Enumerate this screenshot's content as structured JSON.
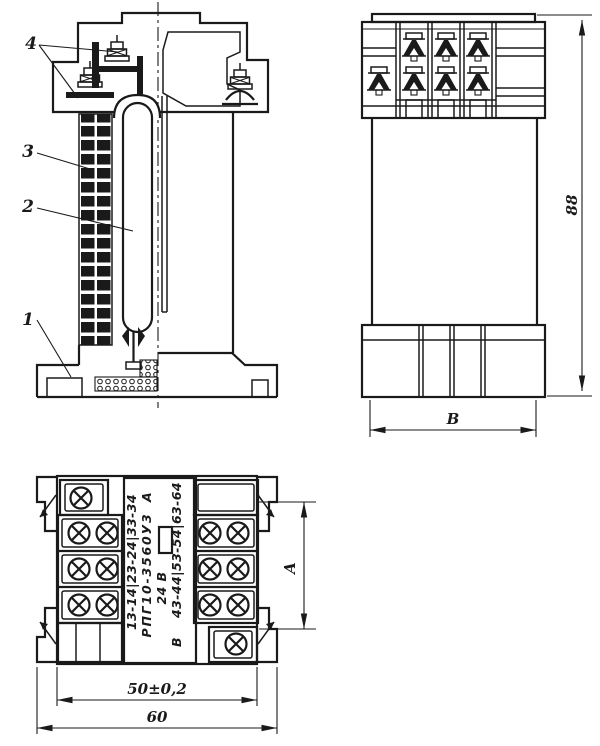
{
  "colors": {
    "ink": "#1a1a1a",
    "paper": "#ffffff"
  },
  "section_view": {
    "callouts": [
      {
        "label": "1"
      },
      {
        "label": "2"
      },
      {
        "label": "3"
      },
      {
        "label": "4"
      }
    ]
  },
  "side_view": {
    "dim_height": "88",
    "dim_width": "В"
  },
  "bottom_view": {
    "nameplate": {
      "contacts_left": "13-14|23-24|33-34",
      "terminal_a": "А",
      "model": "РПГ10-3560У3",
      "voltage": "24 В",
      "terminal_b": "В",
      "contacts_right": "43-44|53-54|63-64"
    },
    "dim_span": "А",
    "dim_mounting": "50±0,2",
    "dim_overall": "60"
  }
}
